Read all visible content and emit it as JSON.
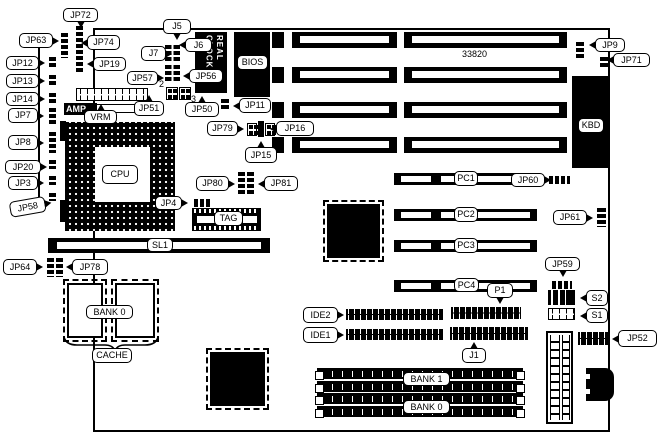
{
  "diagram": {
    "title_ref": "motherboard-jumper-diagram",
    "board_ref": "33820",
    "chips": {
      "rtc_text": "REAL CLOCK",
      "amp_text": "AMP",
      "kbd_label": "KBD",
      "bios_label": "BIOS"
    },
    "callouts": [
      {
        "t": "JP72",
        "x": 63,
        "y": 8,
        "w": 35,
        "h": 14,
        "tail": "d"
      },
      {
        "t": "JP63",
        "x": 19,
        "y": 33,
        "w": 34,
        "h": 15,
        "tail": "r"
      },
      {
        "t": "JP74",
        "x": 87,
        "y": 35,
        "w": 33,
        "h": 15,
        "tail": "l"
      },
      {
        "t": "J5",
        "x": 163,
        "y": 19,
        "w": 28,
        "h": 15,
        "tail": "d"
      },
      {
        "t": "J6",
        "x": 185,
        "y": 38,
        "w": 27,
        "h": 14,
        "tail": "l"
      },
      {
        "t": "J7",
        "x": 141,
        "y": 46,
        "w": 25,
        "h": 15,
        "tail": "r"
      },
      {
        "t": "JP12",
        "x": 6,
        "y": 56,
        "w": 33,
        "h": 14,
        "tail": "r"
      },
      {
        "t": "JP19",
        "x": 93,
        "y": 57,
        "w": 33,
        "h": 14,
        "tail": "l"
      },
      {
        "t": "JP57",
        "x": 127,
        "y": 71,
        "w": 31,
        "h": 14,
        "tail": "r"
      },
      {
        "t": "JP56",
        "x": 189,
        "y": 69,
        "w": 34,
        "h": 14,
        "tail": "l"
      },
      {
        "t": "JP13",
        "x": 6,
        "y": 74,
        "w": 33,
        "h": 14,
        "tail": "r"
      },
      {
        "t": "JP14",
        "x": 6,
        "y": 92,
        "w": 33,
        "h": 14,
        "tail": "r"
      },
      {
        "t": "JP9",
        "x": 595,
        "y": 38,
        "w": 30,
        "h": 14,
        "tail": "l"
      },
      {
        "t": "JP71",
        "x": 613,
        "y": 53,
        "w": 37,
        "h": 14,
        "tail": "l"
      },
      {
        "t": "JP7",
        "x": 8,
        "y": 108,
        "w": 30,
        "h": 15,
        "tail": "r"
      },
      {
        "t": "JP51",
        "x": 134,
        "y": 101,
        "w": 30,
        "h": 15,
        "tail": "u"
      },
      {
        "t": "JP50",
        "x": 185,
        "y": 102,
        "w": 34,
        "h": 15,
        "tail": "u"
      },
      {
        "t": "JP11",
        "x": 239,
        "y": 98,
        "w": 32,
        "h": 15,
        "tail": "l"
      },
      {
        "t": "VRM",
        "x": 84,
        "y": 110,
        "w": 33,
        "h": 14,
        "tail": "u"
      },
      {
        "t": "JP79",
        "x": 207,
        "y": 121,
        "w": 31,
        "h": 15,
        "tail": "r"
      },
      {
        "t": "JP16",
        "x": 276,
        "y": 121,
        "w": 38,
        "h": 15,
        "tail": "l"
      },
      {
        "t": "JP8",
        "x": 8,
        "y": 135,
        "w": 30,
        "h": 15,
        "tail": "r"
      },
      {
        "t": "JP15",
        "x": 245,
        "y": 147,
        "w": 32,
        "h": 16,
        "tail": "u"
      },
      {
        "t": "JP20",
        "x": 5,
        "y": 160,
        "w": 36,
        "h": 14,
        "tail": "r"
      },
      {
        "t": "CPU",
        "x": 102,
        "y": 165,
        "w": 36,
        "h": 19,
        "tail": "n"
      },
      {
        "t": "JP80",
        "x": 196,
        "y": 176,
        "w": 33,
        "h": 15,
        "tail": "r"
      },
      {
        "t": "JP81",
        "x": 264,
        "y": 176,
        "w": 34,
        "h": 15,
        "tail": "l"
      },
      {
        "t": "JP3",
        "x": 8,
        "y": 176,
        "w": 30,
        "h": 14,
        "tail": "r"
      },
      {
        "t": "JP60",
        "x": 511,
        "y": 173,
        "w": 34,
        "h": 14,
        "tail": "r"
      },
      {
        "t": "PC1",
        "x": 454,
        "y": 171,
        "w": 24,
        "h": 15,
        "tail": "n"
      },
      {
        "t": "JP4",
        "x": 155,
        "y": 196,
        "w": 27,
        "h": 14,
        "tail": "r"
      },
      {
        "t": "JP58",
        "x": 10,
        "y": 202,
        "w": 36,
        "h": 16,
        "tail": "r",
        "tilt": -10
      },
      {
        "t": "PC2",
        "x": 454,
        "y": 207,
        "w": 24,
        "h": 15,
        "tail": "n"
      },
      {
        "t": "JP61",
        "x": 553,
        "y": 210,
        "w": 34,
        "h": 15,
        "tail": "r"
      },
      {
        "t": "TAG",
        "x": 214,
        "y": 211,
        "w": 29,
        "h": 15,
        "tail": "n"
      },
      {
        "t": "SL1",
        "x": 147,
        "y": 238,
        "w": 26,
        "h": 14,
        "tail": "n"
      },
      {
        "t": "PC3",
        "x": 454,
        "y": 238,
        "w": 24,
        "h": 15,
        "tail": "n"
      },
      {
        "t": "JP64",
        "x": 3,
        "y": 259,
        "w": 34,
        "h": 16,
        "tail": "r"
      },
      {
        "t": "JP78",
        "x": 72,
        "y": 259,
        "w": 36,
        "h": 16,
        "tail": "l"
      },
      {
        "t": "JP59",
        "x": 545,
        "y": 257,
        "w": 35,
        "h": 14,
        "tail": "d"
      },
      {
        "t": "PC4",
        "x": 454,
        "y": 278,
        "w": 25,
        "h": 14,
        "tail": "n"
      },
      {
        "t": "P1",
        "x": 487,
        "y": 283,
        "w": 26,
        "h": 15,
        "tail": "d"
      },
      {
        "t": "S2",
        "x": 586,
        "y": 290,
        "w": 22,
        "h": 16,
        "tail": "l"
      },
      {
        "t": "BANK 0",
        "x": 86,
        "y": 305,
        "w": 47,
        "h": 14,
        "tail": "n"
      },
      {
        "t": "IDE2",
        "x": 303,
        "y": 307,
        "w": 35,
        "h": 16,
        "tail": "r"
      },
      {
        "t": "S1",
        "x": 586,
        "y": 308,
        "w": 22,
        "h": 15,
        "tail": "l"
      },
      {
        "t": "IDE1",
        "x": 303,
        "y": 327,
        "w": 35,
        "h": 16,
        "tail": "r"
      },
      {
        "t": "JP52",
        "x": 618,
        "y": 330,
        "w": 39,
        "h": 17,
        "tail": "l"
      },
      {
        "t": "CACHE",
        "x": 92,
        "y": 348,
        "w": 40,
        "h": 15,
        "tail": "n"
      },
      {
        "t": "J1",
        "x": 462,
        "y": 348,
        "w": 24,
        "h": 15,
        "tail": "u"
      },
      {
        "t": "BANK 1",
        "x": 403,
        "y": 372,
        "w": 47,
        "h": 14,
        "tail": "n"
      },
      {
        "t": "BANK 0",
        "x": 403,
        "y": 400,
        "w": 47,
        "h": 14,
        "tail": "n"
      },
      {
        "t": "BIOS",
        "x": 237,
        "y": 55,
        "w": 31,
        "h": 15,
        "tail": "n"
      },
      {
        "t": "KBD",
        "x": 578,
        "y": 118,
        "w": 26,
        "h": 15,
        "tail": "n"
      }
    ],
    "plain_texts": [
      {
        "t": "33820",
        "x": 462,
        "y": 50
      },
      {
        "t": "2",
        "x": 159,
        "y": 80
      },
      {
        "t": "3",
        "x": 191,
        "y": 95
      }
    ],
    "jumpers": [
      {
        "k": "v",
        "x": 61,
        "y": 33,
        "w": 7,
        "h": 25
      },
      {
        "k": "v",
        "x": 76,
        "y": 26,
        "w": 7,
        "h": 46
      },
      {
        "k": "v",
        "x": 49,
        "y": 57,
        "w": 7,
        "h": 11
      },
      {
        "k": "v",
        "x": 49,
        "y": 75,
        "w": 7,
        "h": 11
      },
      {
        "k": "v",
        "x": 49,
        "y": 93,
        "w": 7,
        "h": 11
      },
      {
        "k": "v",
        "x": 49,
        "y": 108,
        "w": 7,
        "h": 17
      },
      {
        "k": "v",
        "x": 49,
        "y": 132,
        "w": 7,
        "h": 21
      },
      {
        "k": "v",
        "x": 49,
        "y": 160,
        "w": 7,
        "h": 9
      },
      {
        "k": "v",
        "x": 49,
        "y": 176,
        "w": 7,
        "h": 9
      },
      {
        "k": "v",
        "x": 49,
        "y": 193,
        "w": 7,
        "h": 8
      },
      {
        "k": "v2",
        "x": 47,
        "y": 258,
        "w": 16,
        "h": 19
      },
      {
        "k": "v2",
        "x": 165,
        "y": 45,
        "w": 15,
        "h": 18
      },
      {
        "k": "v2",
        "x": 165,
        "y": 65,
        "w": 15,
        "h": 18
      },
      {
        "k": "grid",
        "x": 166,
        "y": 87,
        "w": 12,
        "h": 13
      },
      {
        "k": "grid",
        "x": 179,
        "y": 87,
        "w": 12,
        "h": 13
      },
      {
        "k": "v",
        "x": 221,
        "y": 99,
        "w": 8,
        "h": 11
      },
      {
        "k": "grid",
        "x": 247,
        "y": 123,
        "w": 10,
        "h": 13
      },
      {
        "k": "bar",
        "x": 258,
        "y": 121,
        "w": 6,
        "h": 16
      },
      {
        "k": "grid",
        "x": 265,
        "y": 123,
        "w": 10,
        "h": 13
      },
      {
        "k": "v2",
        "x": 238,
        "y": 172,
        "w": 16,
        "h": 24
      },
      {
        "k": "h",
        "x": 194,
        "y": 199,
        "w": 16,
        "h": 8
      },
      {
        "k": "v",
        "x": 576,
        "y": 42,
        "w": 8,
        "h": 17
      },
      {
        "k": "v",
        "x": 600,
        "y": 57,
        "w": 8,
        "h": 12
      },
      {
        "k": "h",
        "x": 549,
        "y": 176,
        "w": 21,
        "h": 8
      },
      {
        "k": "v",
        "x": 597,
        "y": 208,
        "w": 9,
        "h": 19
      },
      {
        "k": "h",
        "x": 552,
        "y": 281,
        "w": 20,
        "h": 8
      }
    ],
    "slots": {
      "isa_rows_y": [
        32,
        67,
        102,
        137
      ],
      "pci_rows_y": [
        173,
        209,
        240,
        280
      ],
      "simm_rows_y": [
        368,
        381,
        393,
        406
      ]
    },
    "headers_dark": [
      {
        "n": "ide2-connector",
        "x": 346,
        "y": 309,
        "w": 97,
        "h": 11
      },
      {
        "n": "ide1-connector",
        "x": 346,
        "y": 329,
        "w": 97,
        "h": 11
      },
      {
        "n": "p1-connector",
        "x": 451,
        "y": 307,
        "w": 70,
        "h": 12
      },
      {
        "n": "j1-connector",
        "x": 450,
        "y": 327,
        "w": 78,
        "h": 13
      },
      {
        "n": "jp52-connector",
        "x": 578,
        "y": 332,
        "w": 30,
        "h": 13
      }
    ]
  }
}
